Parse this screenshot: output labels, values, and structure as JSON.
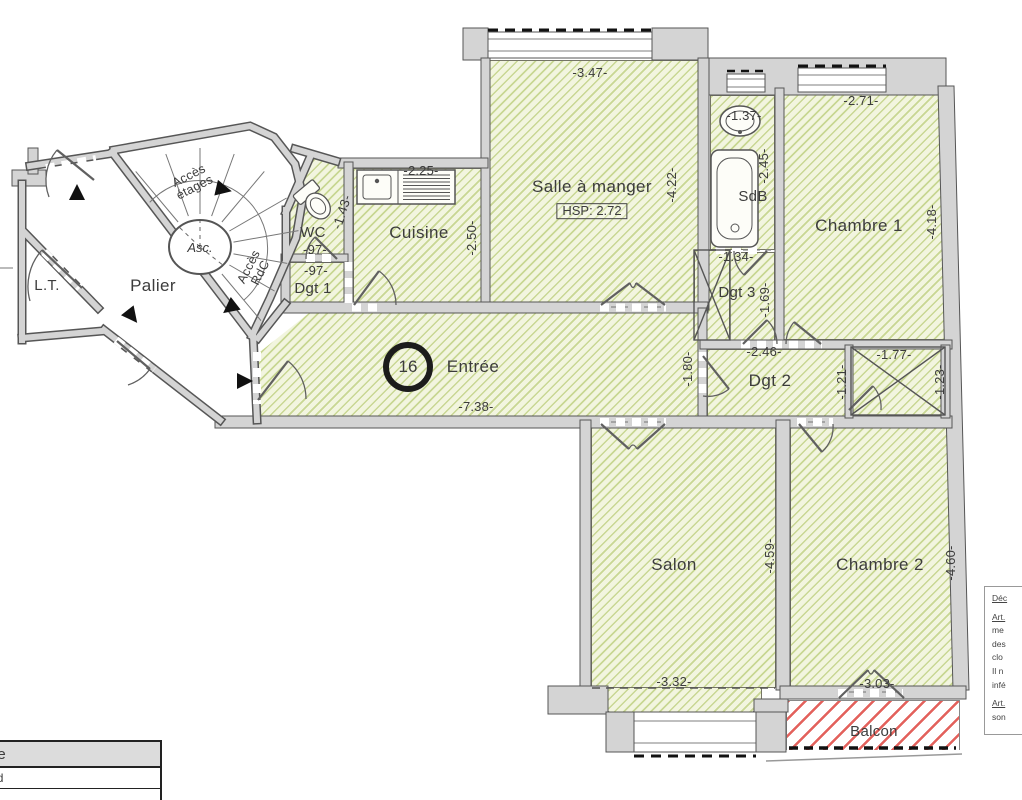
{
  "rooms": {
    "salle_a_manger": {
      "label": "Salle à manger",
      "hsp": "HSP: 2.72",
      "dim_width": "-3.47-",
      "dim_height": "-4.22-"
    },
    "sdb": {
      "label": "SdB",
      "dim_width": "-1.37-",
      "dim_height": "-2.45-"
    },
    "chambre1": {
      "label": "Chambre 1",
      "dim_width": "-2.71-",
      "dim_height": "-4.18-"
    },
    "dgt3": {
      "label": "Dgt 3",
      "dim_width": "-1.34-",
      "dim_height": "-1.69-"
    },
    "cuisine": {
      "label": "Cuisine",
      "dim_width": "-2.25-",
      "dim_height": "-2.50-"
    },
    "wc": {
      "label": "WC",
      "dim_width": "-97-",
      "dim_height": "-1.43-"
    },
    "dgt1": {
      "label": "Dgt 1",
      "dim_width": "-97-"
    },
    "entree": {
      "label": "Entrée",
      "lot_number": "16",
      "dim_width": "-7.38-"
    },
    "dgt2": {
      "label": "Dgt 2",
      "dim_width": "-2.46-",
      "dim_left": "-1.80-",
      "dim_right": "-1.21-"
    },
    "placard": {
      "dim_width": "-1.77-",
      "dim_height": "-1.23-"
    },
    "salon": {
      "label": "Salon",
      "dim_width": "-3.32-",
      "dim_height": "-4.59-"
    },
    "chambre2": {
      "label": "Chambre 2",
      "dim_width": "-3.03-",
      "dim_height": "-4.60-"
    },
    "balcon": {
      "label": "Balcon"
    }
  },
  "common_areas": {
    "palier": {
      "label": "Palier"
    },
    "lt": {
      "label": "L.T."
    },
    "stairs": {
      "elevator": "Asc.",
      "up_line1": "Accès",
      "up_line2": "étages",
      "down_line1": "Accès",
      "down_line2": "RdC"
    }
  },
  "legend": {
    "header": "gende",
    "row1": "olafond",
    "row2": "s"
  },
  "note": {
    "l1": "Déc",
    "l2": "Art.",
    "l3": "me",
    "l4": "des",
    "l5": "clo",
    "l6": "Il n",
    "l7": "infé",
    "l8": "Art.",
    "l9": "son"
  },
  "colors": {
    "room_hatch_line": "#a6be55",
    "room_fill": "#f2f5df",
    "wall_fill": "#d4d4d4",
    "wall_edge": "#565656",
    "balcony_hatch": "#e0504a",
    "text": "#3c3c3c"
  }
}
